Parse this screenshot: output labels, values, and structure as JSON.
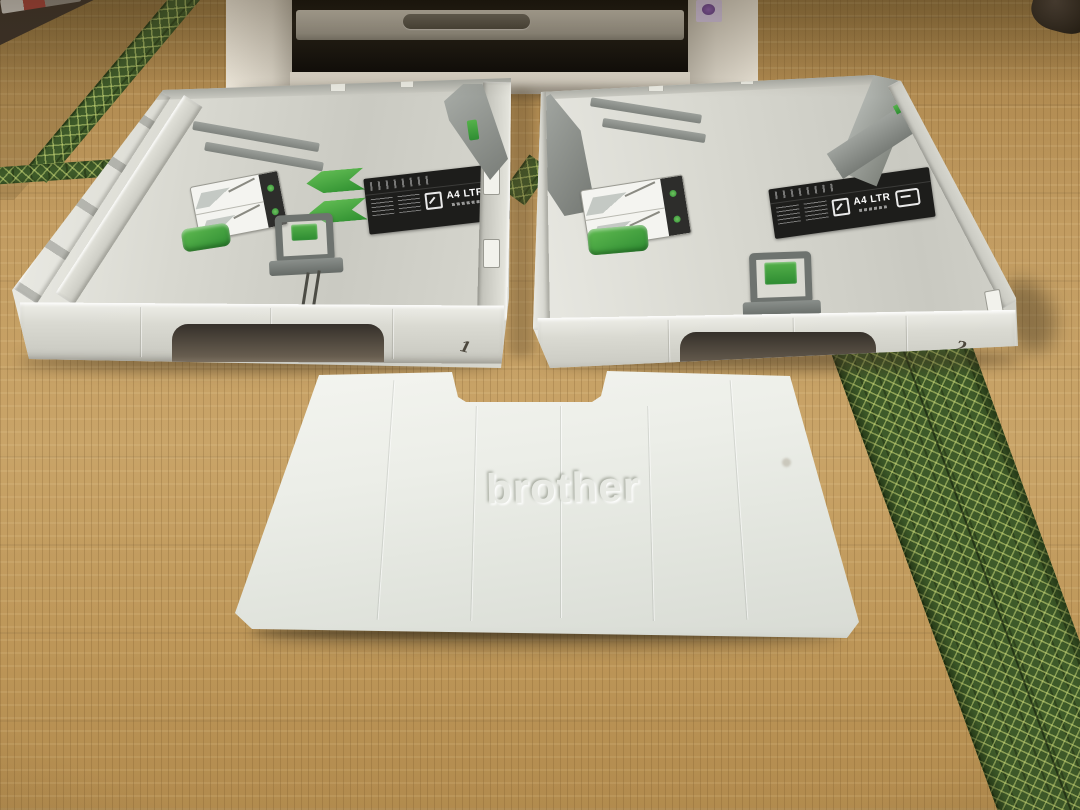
{
  "colors": {
    "tatami": "#bf9a5e",
    "tatami_border_green": "#3e5a29",
    "tatami_border_accent": "#cedd7a",
    "tray_body": "#d6d6ce",
    "tray_accent_green": "#46a33c",
    "guide_gray": "#828783",
    "label_black": "#1d1d1b",
    "cover_white": "#eceee8",
    "printer_body": "#d7d1c4",
    "printer_slot": "#201c14",
    "sticker_purple": "#cfc0dc"
  },
  "trays": [
    {
      "number": "1",
      "size_label": "A4 LTR"
    },
    {
      "number": "2",
      "size_label": "A4 LTR"
    }
  ],
  "cover": {
    "logo": "brother"
  }
}
